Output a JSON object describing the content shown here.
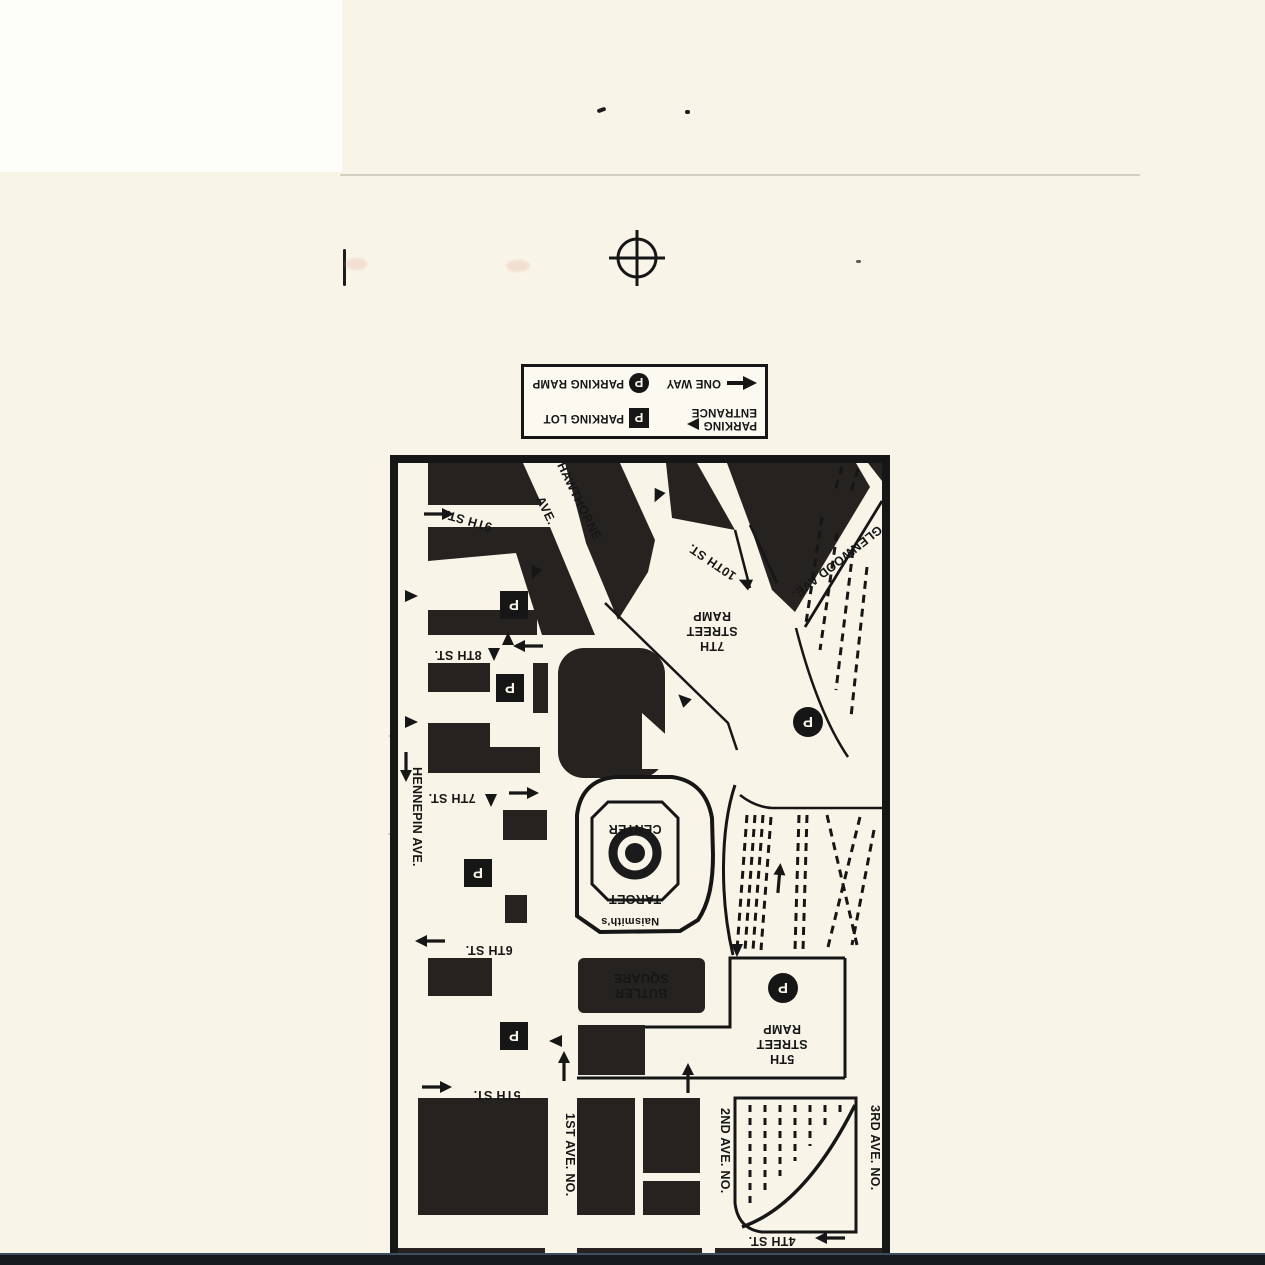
{
  "legend": {
    "one_way": "ONE WAY",
    "parking_ramp": "PARKING RAMP",
    "parking_line1": "PARKING",
    "parking_line2": "ENTRANCE",
    "parking_lot": "PARKING LOT",
    "p": "P"
  },
  "map": {
    "streets": {
      "st9": "9TH ST.",
      "st8": "8TH ST.",
      "st7": "7TH ST.",
      "st6": "6TH ST.",
      "st5": "5TH ST.",
      "st4": "4TH ST.",
      "st10": "10TH ST.",
      "hawthorne1": "HAWTHORNE",
      "hawthorne2": "AVE.",
      "glenwood": "GLENWOOD AVE.",
      "hennepin": "HENNEPIN AVE.",
      "ave1": "1ST AVE. NO.",
      "ave2": "2ND AVE. NO.",
      "ave3": "3RD AVE. NO."
    },
    "places": {
      "ramp7_l1": "7TH",
      "ramp7_l2": "STREET",
      "ramp7_l3": "RAMP",
      "ramp5_l1": "5TH",
      "ramp5_l2": "STREET",
      "ramp5_l3": "RAMP",
      "butler_l1": "BUTLER",
      "butler_l2": "SQUARE",
      "target_l1": "TARGET",
      "target_l2": "CENTER",
      "naismiths": "Naismith's"
    },
    "parking_symbol": "P"
  },
  "colors": {
    "ink": "#161616",
    "paper": "#f8f4e8",
    "scan_edge": "#171a1f"
  }
}
